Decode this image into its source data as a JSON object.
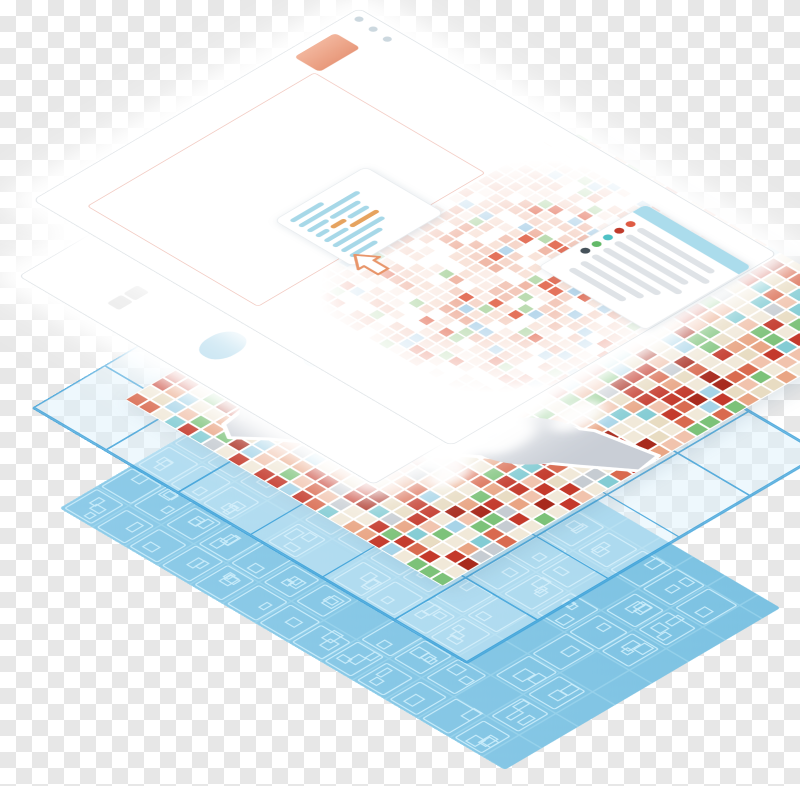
{
  "scene": {
    "kind": "isometric-map-layer-stack-illustration",
    "layers": [
      {
        "id": "browser-sheet",
        "desc": "white browser window sheet with popup, selection frame and legend"
      },
      {
        "id": "basemap-sheet",
        "desc": "white sheet with pale basemap and map controls"
      },
      {
        "id": "parcel-map-layer",
        "desc": "colorful city parcel map with harbor"
      },
      {
        "id": "tile-grid-layer",
        "desc": "translucent blue tile grid sheet"
      },
      {
        "id": "footprint-layer",
        "desc": "blue sheet with building footprint outlines"
      }
    ]
  },
  "colors": {
    "checker": "#e7e7e7",
    "sheet": "#ffffff",
    "sheet_edge": "#dde2e6",
    "window_dot": "#ccd8df",
    "badge_hi": "#f2b59c",
    "badge": "#e8997b",
    "frame": "#f1c6bd",
    "skel_blue": "#a7d8e8",
    "skel_orange": "#e6a35f",
    "arrow": "#e8956a",
    "legend_band": "#abdcec",
    "legend_line": "#dfe3e7",
    "grid_line": "#3ea2d9",
    "grid_fill": "rgba(219,239,250,0.58)",
    "water_patch": "#c6e4f2",
    "fp_bg": "#7cc2e2",
    "fp_line": "#c9ecfa",
    "fp_line2": "#aadef2",
    "map_land": "#f1e9d9",
    "map_water": "#c9ced6",
    "map_road": "#ffffff",
    "pier_gray": "#ced3d9"
  },
  "browser": {
    "window_dots": 3,
    "popup": {
      "lines": [
        [
          {
            "c": "blue",
            "w": 42
          }
        ],
        [
          {
            "c": "blue",
            "w": 78
          }
        ],
        [
          {
            "c": "blue",
            "w": 26
          },
          {
            "c": "blue",
            "w": 38
          }
        ],
        [
          {
            "c": "blue",
            "w": 16
          },
          {
            "c": "orange",
            "w": 18
          },
          {
            "c": "blue",
            "w": 26
          }
        ],
        [
          {
            "c": "blue",
            "w": 30
          },
          {
            "c": "orange",
            "w": 36
          }
        ],
        [
          {
            "c": "blue",
            "w": 66
          }
        ],
        [
          {
            "c": "blue",
            "w": 52
          }
        ],
        [
          {
            "c": "blue",
            "w": 34
          }
        ]
      ]
    },
    "legend": {
      "rows": [
        {
          "dot": "#df5b43",
          "h": 118
        },
        {
          "dot": "#bf3a2b",
          "h": 128
        },
        {
          "dot": "#4fc1c5",
          "h": 112
        },
        {
          "dot": "#63b968",
          "h": 120
        },
        {
          "dot": "#46525a",
          "h": 104
        },
        {
          "dot": null,
          "h": 96
        },
        {
          "dot": null,
          "h": 86
        }
      ]
    }
  },
  "maps": {
    "parcel": {
      "seed": 7,
      "w": 640,
      "h": 450,
      "step": 18,
      "street_w": 2.5,
      "palette": [
        [
          "#c4392b",
          0.14
        ],
        [
          "#a82a1d",
          0.05
        ],
        [
          "#d96a4f",
          0.06
        ],
        [
          "#e9a584",
          0.08
        ],
        [
          "#f1c3ad",
          0.07
        ],
        [
          "#7cc279",
          0.08
        ],
        [
          "#83ccd4",
          0.05
        ],
        [
          "#a6d4e8",
          0.05
        ],
        [
          "#c6ccd2",
          0.04
        ],
        [
          "#e8dcc2",
          0.1
        ]
      ]
    },
    "pale_a": {
      "seed": 11,
      "w": 360,
      "h": 300,
      "step": 14,
      "street_w": 2,
      "palette": [
        [
          "#f6d7cb",
          0.16
        ],
        [
          "#f3c9bb",
          0.12
        ],
        [
          "#f9e4da",
          0.14
        ],
        [
          "#f0b9a8",
          0.07
        ],
        [
          "#e4735c",
          0.04
        ],
        [
          "#bcdcb2",
          0.07
        ],
        [
          "#b9d8ec",
          0.05
        ],
        [
          "#fbeee8",
          0.1
        ]
      ]
    },
    "pale_b": {
      "seed": 23,
      "w": 250,
      "h": 330,
      "step": 14,
      "street_w": 2,
      "palette": [
        [
          "#f6d7cb",
          0.14
        ],
        [
          "#f3c9bb",
          0.1
        ],
        [
          "#f9e4da",
          0.13
        ],
        [
          "#f0b9a8",
          0.06
        ],
        [
          "#e4735c",
          0.03
        ],
        [
          "#bcdcb2",
          0.06
        ],
        [
          "#b9d8ec",
          0.05
        ],
        [
          "#fbeee8",
          0.1
        ]
      ]
    },
    "footprints": {
      "seed": 5,
      "w": 390,
      "h": 630,
      "bx": 52,
      "by": 46
    }
  }
}
